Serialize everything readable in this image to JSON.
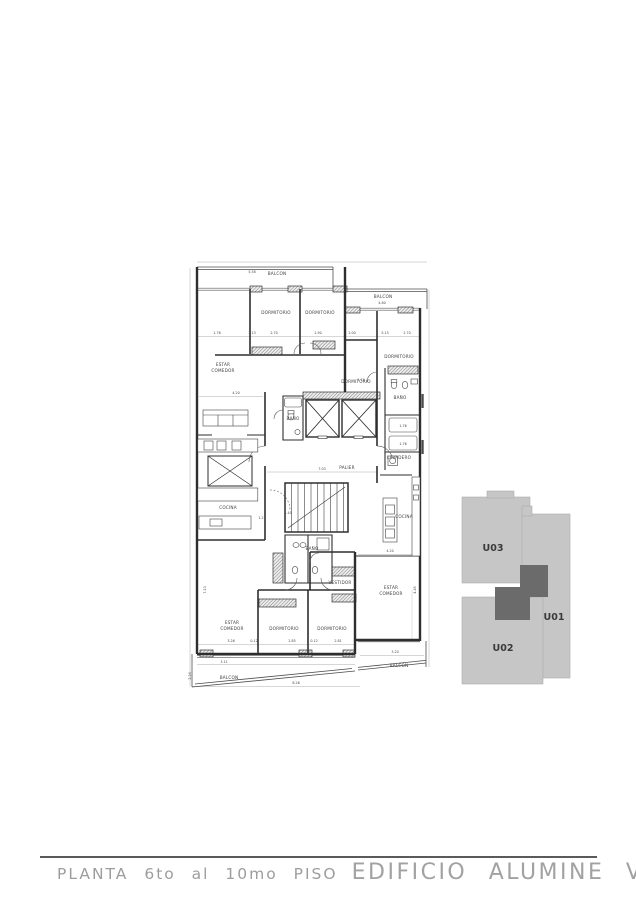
{
  "title": {
    "plan_label": "PLANTA 6to al 10mo PISO",
    "building_label": "EDIFICIO ALUMINE VIII"
  },
  "key_plan": {
    "unit_fill": "#c6c6c6",
    "core_fill": "#6b6b6b",
    "units": [
      {
        "id": "U03",
        "x": 493,
        "y": 551
      },
      {
        "id": "U01",
        "x": 554,
        "y": 620
      },
      {
        "id": "U02",
        "x": 503,
        "y": 651
      }
    ]
  },
  "floor_plan": {
    "rooms": [
      {
        "label": "BALCON",
        "x": 277,
        "y": 275
      },
      {
        "label": "DORMITORIO",
        "x": 276,
        "y": 314
      },
      {
        "label": "DORMITORIO",
        "x": 320,
        "y": 314
      },
      {
        "label": "BALCON",
        "x": 383,
        "y": 298
      },
      {
        "label": "DORMITORIO",
        "x": 399,
        "y": 358
      },
      {
        "label": "ESTAR",
        "x": 223,
        "y": 366
      },
      {
        "label": "COMEDOR",
        "x": 223,
        "y": 372
      },
      {
        "label": "DORMITORIO",
        "x": 356,
        "y": 383
      },
      {
        "label": "BAÑO",
        "x": 400,
        "y": 399
      },
      {
        "label": "BAÑO",
        "x": 293,
        "y": 420
      },
      {
        "label": "LAVADERO",
        "x": 399,
        "y": 459
      },
      {
        "label": "PALIER",
        "x": 347,
        "y": 469
      },
      {
        "label": "COCINA",
        "x": 228,
        "y": 509
      },
      {
        "label": "COCINA",
        "x": 404,
        "y": 518
      },
      {
        "label": "BAÑO",
        "x": 312,
        "y": 550
      },
      {
        "label": "VESTIDOR",
        "x": 340,
        "y": 584
      },
      {
        "label": "ESTAR",
        "x": 391,
        "y": 589
      },
      {
        "label": "COMEDOR",
        "x": 391,
        "y": 595
      },
      {
        "label": "ESTAR",
        "x": 232,
        "y": 624
      },
      {
        "label": "COMEDOR",
        "x": 232,
        "y": 630
      },
      {
        "label": "DORMITORIO",
        "x": 284,
        "y": 630
      },
      {
        "label": "DORMITORIO",
        "x": 332,
        "y": 630
      },
      {
        "label": "BALCON",
        "x": 229,
        "y": 679
      },
      {
        "label": "BALCON",
        "x": 399,
        "y": 667
      }
    ],
    "dimensions": [
      {
        "v": "5.58",
        "x": 252,
        "y": 273
      },
      {
        "v": "4.80",
        "x": 382,
        "y": 304
      },
      {
        "v": "1.76",
        "x": 217,
        "y": 334
      },
      {
        "v": "3.13",
        "x": 252,
        "y": 334
      },
      {
        "v": "2.70",
        "x": 274,
        "y": 334
      },
      {
        "v": "2.90",
        "x": 318,
        "y": 334
      },
      {
        "v": "2.00",
        "x": 352,
        "y": 334
      },
      {
        "v": "5.15",
        "x": 385,
        "y": 334
      },
      {
        "v": "2.70",
        "x": 407,
        "y": 334
      },
      {
        "v": "1.74",
        "x": 361,
        "y": 381
      },
      {
        "v": "4.20",
        "x": 236,
        "y": 394
      },
      {
        "v": "7.03",
        "x": 322,
        "y": 470
      },
      {
        "v": "1.40",
        "x": 288,
        "y": 514
      },
      {
        "v": "1.21",
        "x": 262,
        "y": 519
      },
      {
        "v": "1.76",
        "x": 403,
        "y": 427
      },
      {
        "v": "1.76",
        "x": 403,
        "y": 445
      },
      {
        "v": "4.20",
        "x": 390,
        "y": 552
      },
      {
        "v": "4.45",
        "x": 416,
        "y": 590,
        "rot": -90
      },
      {
        "v": "7.13",
        "x": 206,
        "y": 590,
        "rot": -90
      },
      {
        "v": "3.26",
        "x": 231,
        "y": 642
      },
      {
        "v": "0.12",
        "x": 254,
        "y": 642
      },
      {
        "v": "2.85",
        "x": 292,
        "y": 642
      },
      {
        "v": "0.12",
        "x": 314,
        "y": 642
      },
      {
        "v": "2.81",
        "x": 338,
        "y": 642
      },
      {
        "v": "3.20",
        "x": 395,
        "y": 653
      },
      {
        "v": "3.11",
        "x": 224,
        "y": 663
      },
      {
        "v": "8.26",
        "x": 296,
        "y": 684
      },
      {
        "v": "2.24",
        "x": 191,
        "y": 676,
        "rot": -90
      }
    ]
  }
}
